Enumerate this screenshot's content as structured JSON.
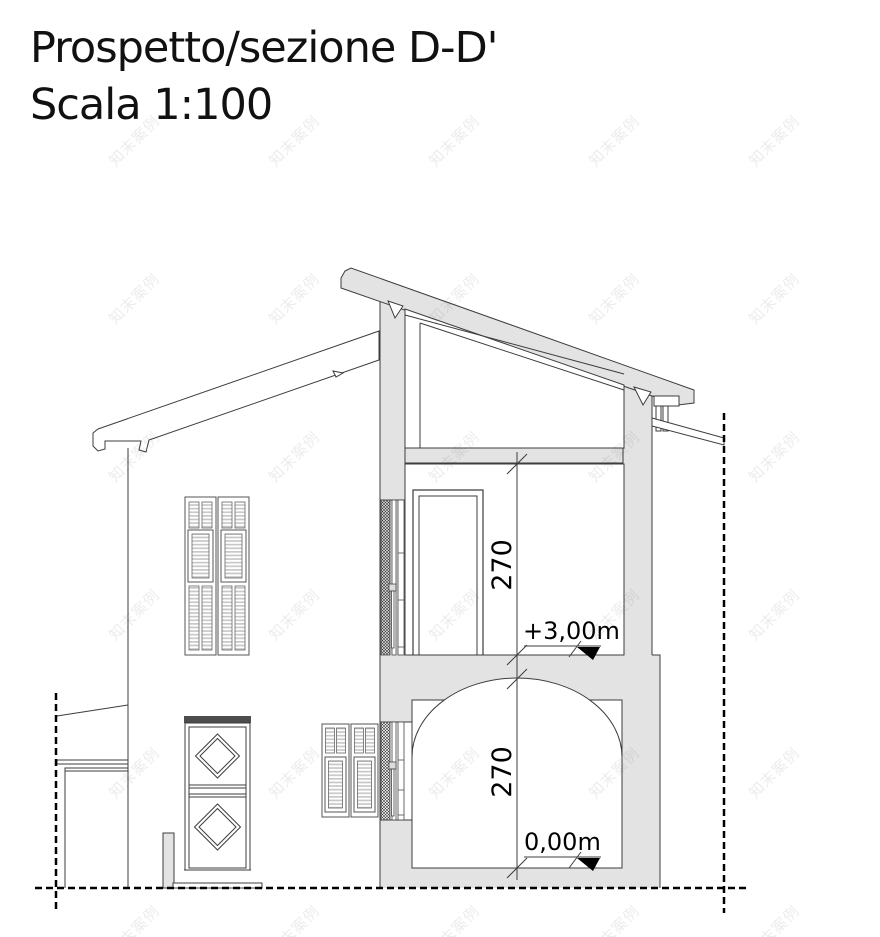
{
  "title": {
    "line1": "Prospetto/sezione D-D'",
    "line2": "Scala 1:100"
  },
  "dimensions": {
    "upper_room_height_cm": "270",
    "lower_room_height_cm": "270"
  },
  "levels": {
    "first_floor": "+3,00m",
    "ground_floor": "0,00m"
  },
  "watermark": {
    "text": "知末案例"
  },
  "colors": {
    "section_fill": "#e3e3e3",
    "line": "#3d3d3d",
    "background": "#ffffff",
    "door_lintel": "#4d4d4d"
  }
}
